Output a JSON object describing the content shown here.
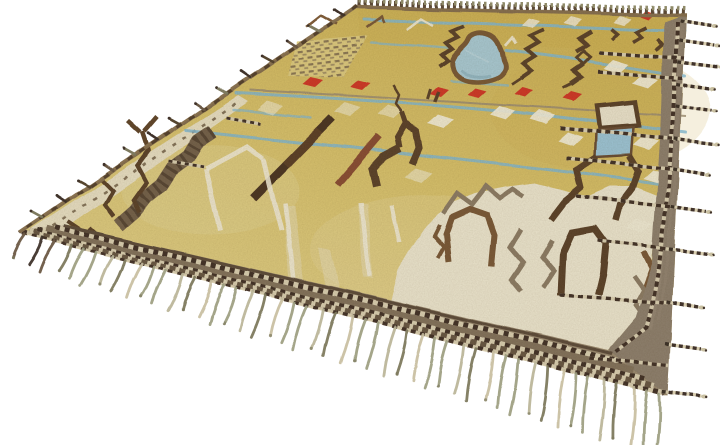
{
  "scene": {
    "background": "#ffffff",
    "subject": "hand-knotted kilim rug photographed at an angle on white"
  },
  "rug": {
    "field_gold": "#d5bf68",
    "field_gold_deep": "#cbb054",
    "field_gold_pale": "#dccf96",
    "cream": "#e9e2cb",
    "ivory": "#efe9d6",
    "border_taupe": "#8e7f6c",
    "border_taupe_dark": "#7b6b55",
    "band_dark": "#5f4d3a",
    "band_cream": "#d8cdaf",
    "selvedge_brown": "#87704f",
    "motif_brown": "#5e452b",
    "motif_brown_light": "#7b5a38",
    "motif_gray": "#8d7c64",
    "motif_redbrown": "#8a4f33",
    "bar_dark": "#4e3823",
    "red": "#ce3a29",
    "lake_fill": "#a8c7d0",
    "lake_edge": "#7b5b36",
    "stripe_blue": "#84b5ca",
    "stripe_gray": "#9b8c72",
    "fringe_sage": "#9fa083",
    "fringe_sage_light": "#bcb69a",
    "fringe_olive_dark": "#7e7a5e",
    "fringe_cream": "#c9c0a2",
    "fringe_brown": "#6b5844",
    "patch_brown": "#75624a",
    "white_line": "#ece6d2"
  },
  "fringe": {
    "bottom_tassel_count": 46,
    "right_tassel_count": 12,
    "left_tuft_count": 14,
    "right_tassel_edge_ys": [
      22,
      42,
      63,
      85,
      107,
      140,
      170,
      207,
      250,
      303,
      345,
      393
    ]
  }
}
